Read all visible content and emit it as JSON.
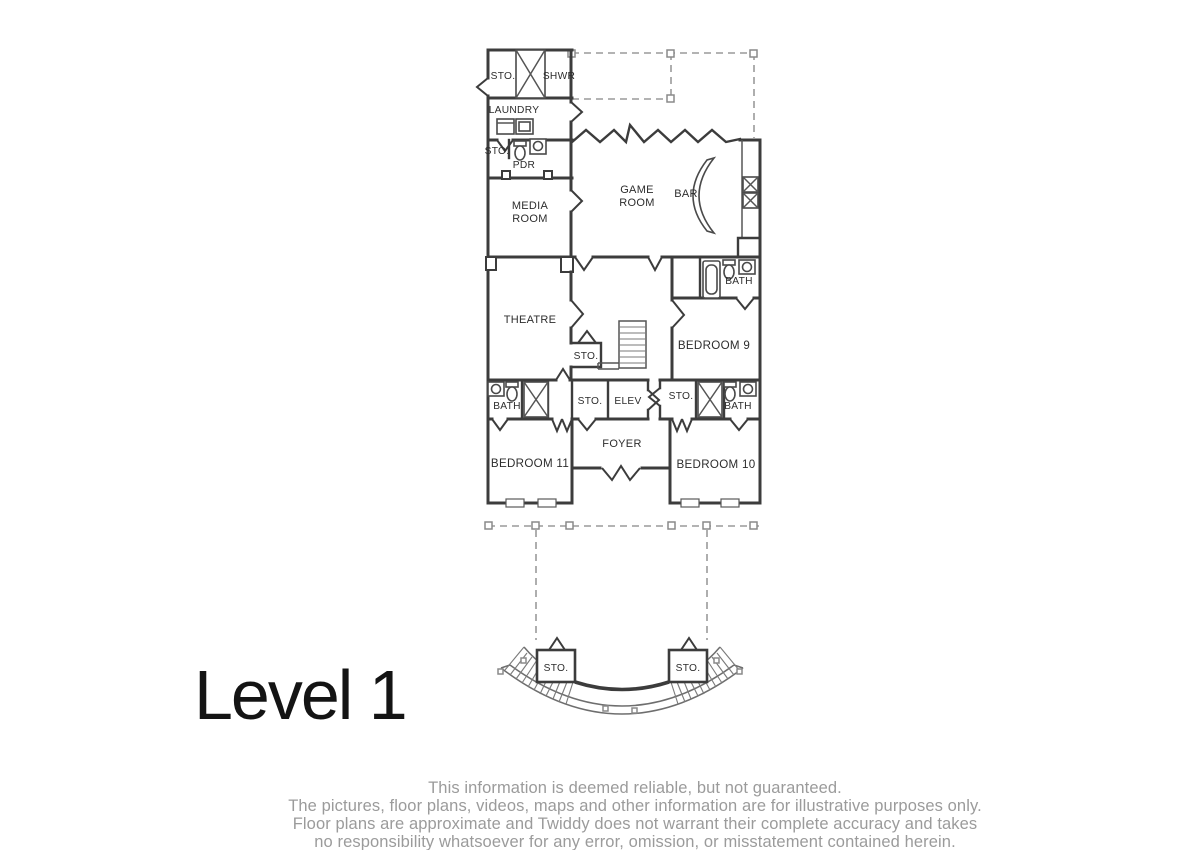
{
  "page": {
    "title": "Level 1"
  },
  "floorplan": {
    "rooms": [
      {
        "id": "storage-top",
        "label": "STO."
      },
      {
        "id": "shower",
        "label": "SHWR"
      },
      {
        "id": "laundry",
        "label": "LAUNDRY"
      },
      {
        "id": "storage-pdr",
        "label": "STO."
      },
      {
        "id": "powder-room",
        "label": "PDR"
      },
      {
        "id": "media-room",
        "lines": [
          "MEDIA",
          "ROOM"
        ]
      },
      {
        "id": "game-room",
        "lines": [
          "GAME",
          "ROOM"
        ]
      },
      {
        "id": "bar",
        "label": "BAR"
      },
      {
        "id": "theatre",
        "label": "THEATRE"
      },
      {
        "id": "bath-bedroom9",
        "label": "BATH"
      },
      {
        "id": "bedroom-9",
        "label": "BEDROOM 9"
      },
      {
        "id": "storage-stair",
        "label": "STO."
      },
      {
        "id": "storage-mid",
        "label": "STO."
      },
      {
        "id": "elevator",
        "label": "ELEV"
      },
      {
        "id": "bath-left",
        "label": "BATH"
      },
      {
        "id": "storage-right",
        "label": "STO."
      },
      {
        "id": "bath-right",
        "label": "BATH"
      },
      {
        "id": "foyer",
        "label": "FOYER"
      },
      {
        "id": "bedroom-11",
        "label": "BEDROOM 11"
      },
      {
        "id": "bedroom-10",
        "label": "BEDROOM 10"
      },
      {
        "id": "storage-porch-left",
        "label": "STO."
      },
      {
        "id": "storage-porch-right",
        "label": "STO."
      }
    ]
  },
  "disclaimer": {
    "lines": [
      "This information is deemed reliable, but not guaranteed.",
      "The pictures, floor plans, videos, maps and other information are for illustrative purposes only.",
      "Floor plans are approximate and Twiddy does not warrant their complete accuracy and takes",
      "no responsibility whatsoever for any error, omission, or misstatement contained herein."
    ]
  },
  "colors": {
    "wall": "#3c3c3c",
    "dashed_deck": "#9a9a9a",
    "room_label": "#2d2d2d",
    "title": "#141414",
    "disclaimer": "#9b9b9b",
    "background": "#ffffff"
  }
}
